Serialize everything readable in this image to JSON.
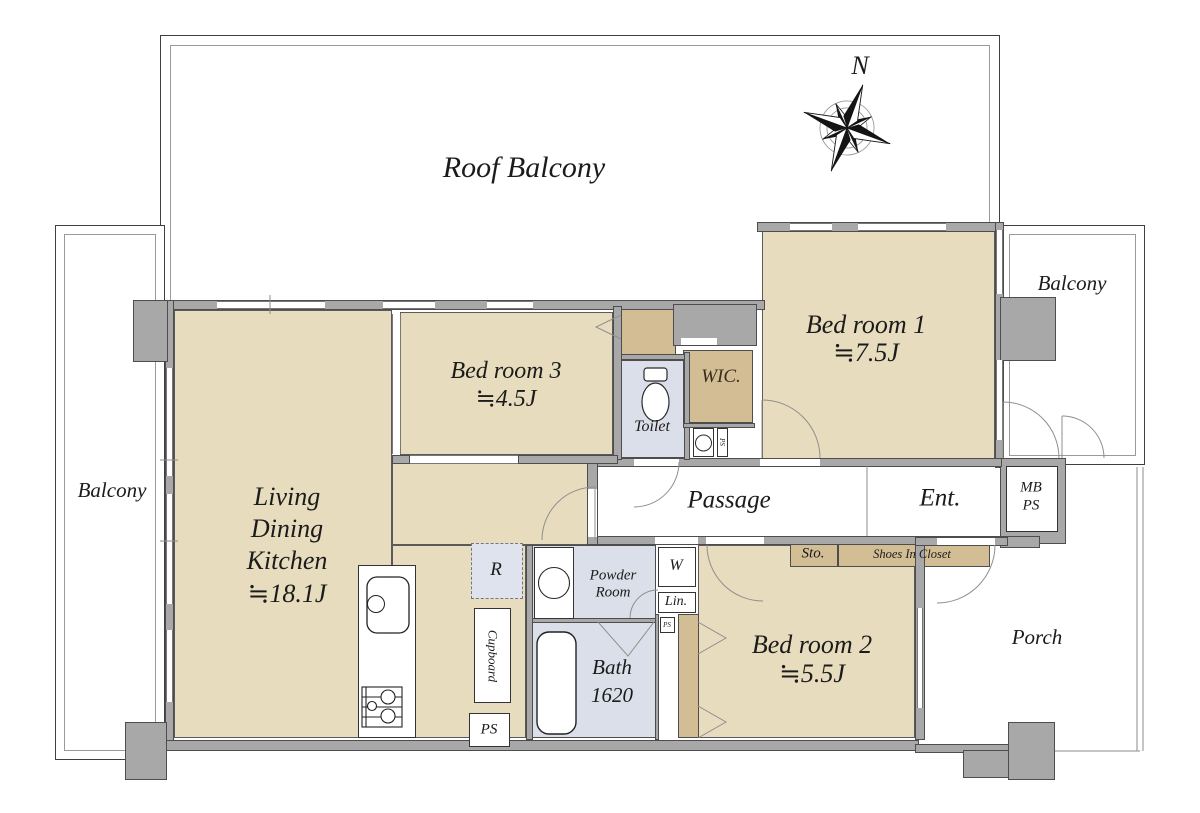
{
  "compass": {
    "north": "N"
  },
  "outdoor": {
    "roof_balcony": "Roof Balcony",
    "balcony_left": "Balcony",
    "balcony_right": "Balcony",
    "porch": "Porch"
  },
  "rooms": {
    "ldk": {
      "line1": "Living",
      "line2": "Dining",
      "line3": "Kitchen",
      "size": "≒18.1J"
    },
    "bedroom1": {
      "name": "Bed room 1",
      "size": "≒7.5J"
    },
    "bedroom2": {
      "name": "Bed room 2",
      "size": "≒5.5J"
    },
    "bedroom3": {
      "name": "Bed room 3",
      "size": "≒4.5J"
    },
    "wic": {
      "name": "WIC."
    },
    "toilet": {
      "name": "Toilet"
    },
    "passage": {
      "name": "Passage"
    },
    "entrance": {
      "name": "Ent."
    },
    "powder_room": {
      "line1": "Powder",
      "line2": "Room"
    },
    "bath": {
      "name": "Bath",
      "size": "1620"
    }
  },
  "features": {
    "mb_ps": {
      "line1": "MB",
      "line2": "PS"
    },
    "storage": "Sto.",
    "shoes_in_closet": "Shoes In Closet",
    "washer": "W",
    "linen": "Lin.",
    "refrigerator": "R",
    "cupboard": "Cupboard",
    "ps_kitchen": "PS",
    "ps_toilet": "PS",
    "ps_hall": "PS"
  },
  "colors": {
    "floor": "#e7dcbd",
    "closet": "#d2bd94",
    "wet_room": "#dbdfe9",
    "wall": "#a8a8a8"
  }
}
